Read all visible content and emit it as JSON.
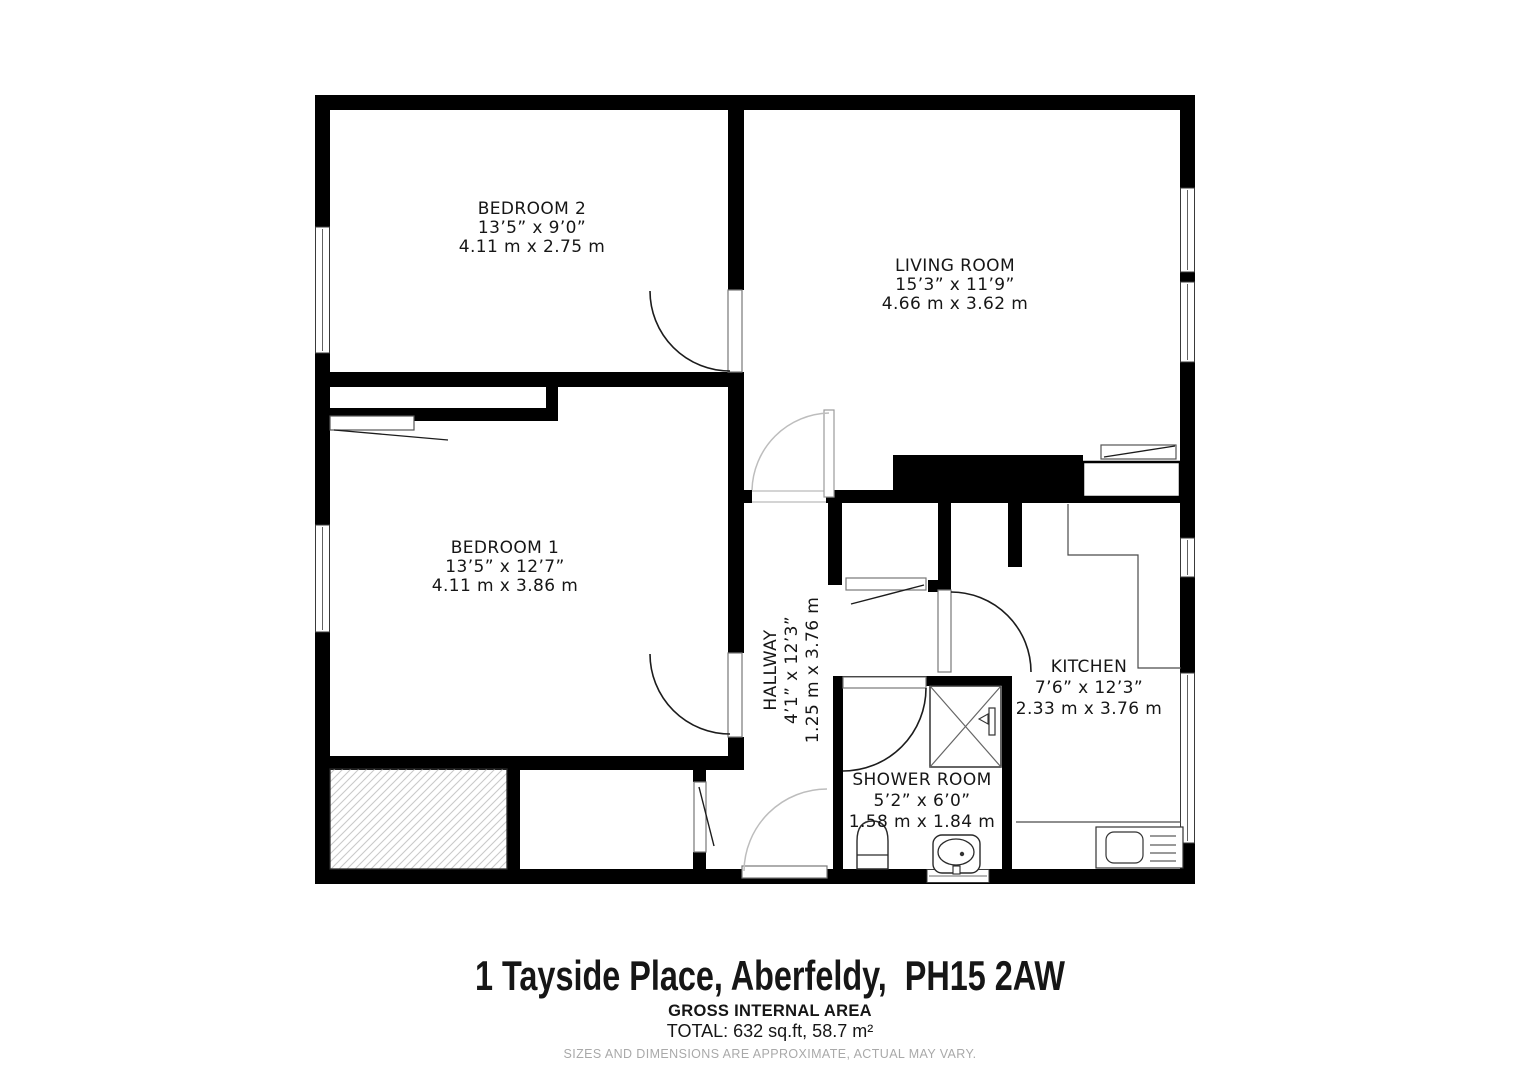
{
  "plan": {
    "rooms": [
      {
        "name": "BEDROOM 2",
        "size_imperial": "13’5” x 9’0”",
        "size_metric": "4.11 m x 2.75 m"
      },
      {
        "name": "LIVING ROOM",
        "size_imperial": "15’3” x 11’9”",
        "size_metric": "4.66 m x 3.62 m"
      },
      {
        "name": "BEDROOM 1",
        "size_imperial": "13’5” x 12’7”",
        "size_metric": "4.11 m x 3.86 m"
      },
      {
        "name": "HALLWAY",
        "size_imperial": "4’1” x 12’3”",
        "size_metric": "1.25 m x 3.76 m"
      },
      {
        "name": "KITCHEN",
        "size_imperial": "7’6” x 12’3”",
        "size_metric": "2.33 m x 3.76 m"
      },
      {
        "name": "SHOWER ROOM",
        "size_imperial": "5’2” x 6’0”",
        "size_metric": "1.58 m x 1.84 m"
      }
    ]
  },
  "footer": {
    "address": "1 Tayside Place, Aberfeldy,  PH15 2AW",
    "area_heading": "GROSS INTERNAL AREA",
    "area_total": "TOTAL: 632 sq.ft, 58.7 m²",
    "disclaimer": "SIZES AND DIMENSIONS ARE APPROXIMATE, ACTUAL MAY VARY."
  },
  "colors": {
    "wall": "#000000",
    "dark_line": "#1c1c1c",
    "light_line": "#bdbdbd",
    "hatch": "#c9c9c9",
    "text": "#161616",
    "muted_text": "#a9a9a9"
  }
}
